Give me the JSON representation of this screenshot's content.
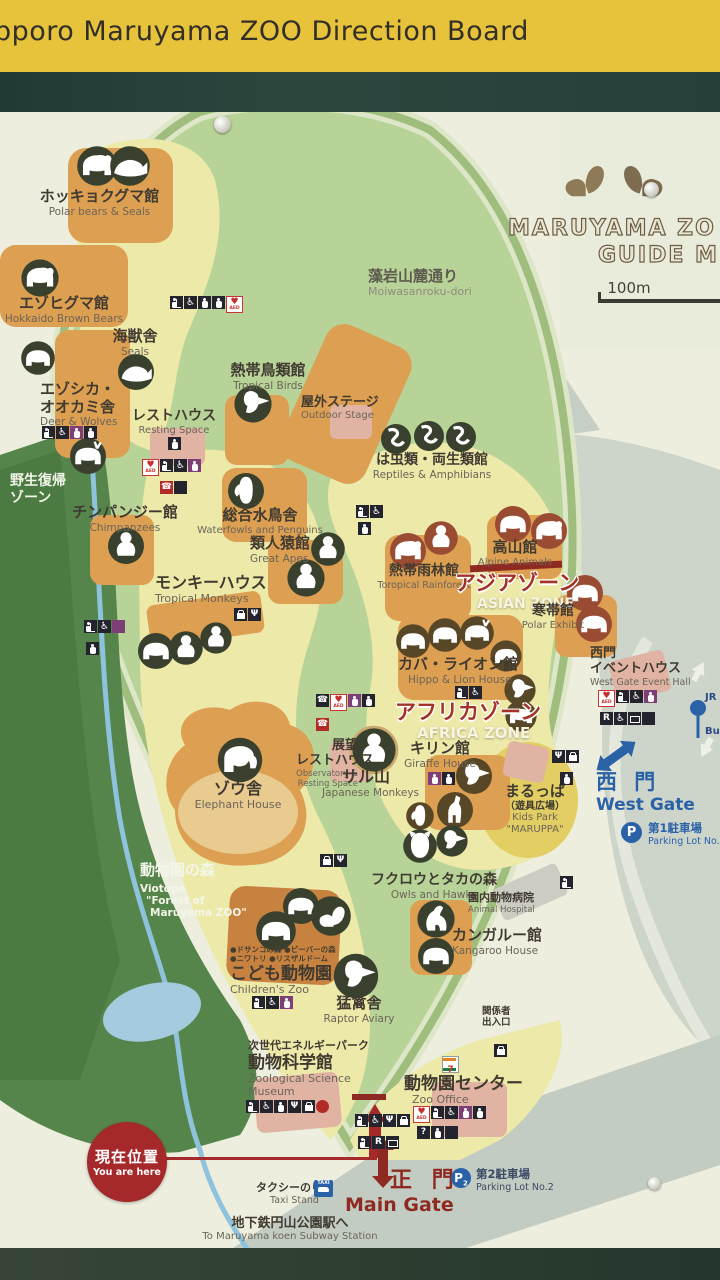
{
  "header": {
    "title": "pporo Maruyama ZOO Direction Board"
  },
  "logo": {
    "line1": "MARUYAMA ZO",
    "line2": "GUIDE M",
    "scale": "100m"
  },
  "road": {
    "ja": "藻岩山麓通り",
    "en": "Moiwasanroku-dori"
  },
  "zones": {
    "wild_return": {
      "ja1": "野生復帰",
      "ja2": "ゾーン"
    },
    "biotope": {
      "ja": "動物園の森",
      "en1": "Viotope",
      "en2": "\"Forest of",
      "en3": "Maruyama ZOO\""
    },
    "asian": {
      "ja": "アジアゾーン",
      "en": "ASIAN ZONE"
    },
    "africa": {
      "ja": "アフリカゾーン",
      "en": "AFRICA ZONE"
    }
  },
  "facilities": {
    "polar_bears": {
      "ja": "ホッキョクグマ館",
      "en": "Polar bears & Seals"
    },
    "brown_bears": {
      "ja": "エゾヒグマ館",
      "en": "Hokkaido Brown Bears"
    },
    "seals": {
      "ja": "海獣舎",
      "en": "Seals"
    },
    "deer_wolves": {
      "ja1": "エゾシカ・",
      "ja2": "オオカミ舎",
      "en": "Deer & Wolves"
    },
    "tropical_birds": {
      "ja": "熱帯鳥類館",
      "en": "Tropical Birds"
    },
    "resting_space": {
      "ja": "レストハウス",
      "en": "Resting Space"
    },
    "outdoor_stage": {
      "ja": "屋外ステージ",
      "en": "Outdoor Stage"
    },
    "reptiles": {
      "ja": "は虫類・両生類館",
      "en": "Reptiles & Amphibians"
    },
    "chimpanzees": {
      "ja": "チンパンジー館",
      "en": "Chimpanzees"
    },
    "waterfowls": {
      "ja": "総合水鳥舎",
      "en": "Waterfowls and Penguins"
    },
    "great_apes": {
      "ja": "類人猿館",
      "en": "Great Apes"
    },
    "monkey_house": {
      "ja": "モンキーハウス",
      "en": "Tropical Monkeys"
    },
    "rainforest": {
      "ja": "熱帯雨林館",
      "en": "Toropical Rainforest"
    },
    "alpine": {
      "ja": "高山館",
      "en": "Alpine Animals"
    },
    "polar_exhibit": {
      "ja": "寒帯館",
      "en": "Polar Exhibit"
    },
    "hippo_lion": {
      "ja": "カバ・ライオン館",
      "en": "Hippo & Lion House"
    },
    "giraffe": {
      "ja": "キリン館",
      "en": "Giraffe House"
    },
    "observatory": {
      "ja1": "展望",
      "ja2": "レストハウス",
      "en1": "Observatory &",
      "en2": "Resting Space"
    },
    "monkey_mountain": {
      "ja": "サル山",
      "en": "Japanese Monkeys"
    },
    "elephant": {
      "ja": "ゾウ舎",
      "en": "Elephant House"
    },
    "kids_park": {
      "ja1": "まるっぱ",
      "ja2": "（遊具広場）",
      "en1": "Kids Park",
      "en2": "\"MARUPPA\""
    },
    "owls_hawks": {
      "ja": "フクロウとタカの森",
      "en": "Owls and Hawks"
    },
    "animal_hospital": {
      "ja": "園内動物病院",
      "en": "Animal Hospital"
    },
    "kangaroo": {
      "ja": "カンガルー館",
      "en": "Kangaroo House"
    },
    "childrens_zoo": {
      "ja": "こども動物園",
      "en": "Children's Zoo",
      "legend1": "●ドサンコの森 ●ビーバーの森",
      "legend2": "●ニワトリ ●リスザルドーム"
    },
    "raptor": {
      "ja": "猛禽舎",
      "en": "Raptor Aviary"
    },
    "science_museum": {
      "ja1": "次世代エネルギーパーク",
      "ja2": "動物科学館",
      "en1": "Zoological Science",
      "en2": "Museum"
    },
    "zoo_office": {
      "ja": "動物園センター",
      "en": "Zoo Office"
    },
    "west_event_hall": {
      "ja1": "西門",
      "ja2": "イベントハウス",
      "en": "West Gate Event Hall"
    },
    "staff_entrance": {
      "ja1": "関係者",
      "ja2": "出入口"
    }
  },
  "gates": {
    "west": {
      "ja": "西 門",
      "en": "West Gate"
    },
    "main": {
      "ja": "正 門",
      "en": "Main Gate"
    }
  },
  "markers": {
    "you_are_here": {
      "ja": "現在位置",
      "en": "You are here"
    },
    "taxi": {
      "ja": "タクシーのりば",
      "en": "Taxi Stand"
    },
    "subway": {
      "ja": "地下鉄円山公園駅へ",
      "en": "To Maruyama koen Subway Station"
    },
    "parking1": {
      "ja": "第1駐車場",
      "en": "Parking Lot No.1"
    },
    "parking2": {
      "ja": "第2駐車場",
      "en": "Parking Lot No.2"
    },
    "jr_bus": {
      "line1": "JR",
      "line2": "Bu"
    }
  },
  "icons": {
    "aed": "AED",
    "parking": "P",
    "two": "2",
    "one": "1",
    "info": "?",
    "recycle": "R",
    "taxi": "TAXI",
    "seven": "7",
    "fork": "Ψ",
    "wheelchair": "♿",
    "phone": "☎"
  },
  "colors": {
    "header_yellow": "#e7c33c",
    "frame_dark": "#2a433c",
    "board_cream": "#edeedd",
    "zoo_green": "#b8d397",
    "forest_green": "#55854b",
    "path_yellow": "#ece9a9",
    "building_orange": "#dd9f51",
    "building_pink": "#e0b3a3",
    "badge_olive": "#39412e",
    "badge_rust": "#9a4c33",
    "badge_brown": "#584726",
    "accent_red": "#a5282b",
    "gate_red": "#8e2a22",
    "gate_blue": "#2b62a7",
    "road_gray": "#c6cfc5"
  }
}
